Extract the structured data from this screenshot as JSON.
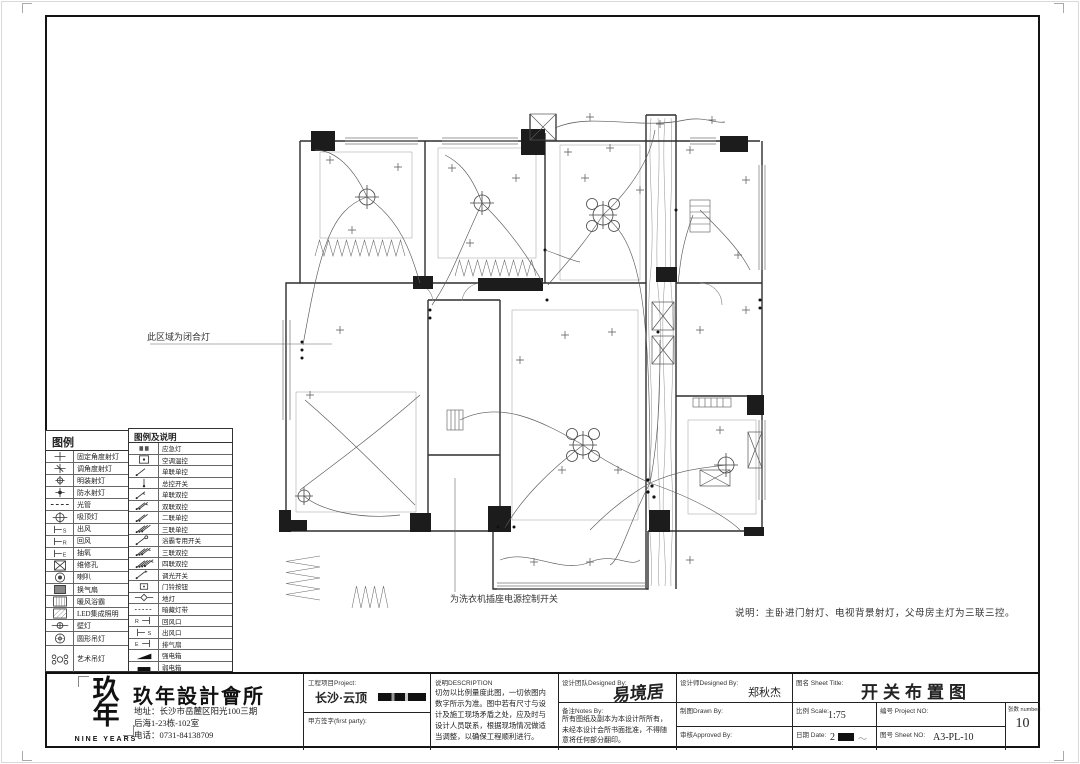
{
  "annotations": {
    "region_note": "此区域为闭合灯",
    "washer_note": "为洗衣机插座电源控制开关",
    "bottom_note": "说明：主卧进门射灯、电视背景射灯，父母房主灯为三联三控。"
  },
  "legend_left": {
    "title": "图例",
    "rows": [
      {
        "icon": "fixed-angle-spotlight-icon",
        "label": "固定角度射灯"
      },
      {
        "icon": "adjustable-angle-spotlight-icon",
        "label": "调角度射灯"
      },
      {
        "icon": "surface-spotlight-icon",
        "label": "明装射灯"
      },
      {
        "icon": "waterproof-spotlight-icon",
        "label": "防水射灯"
      },
      {
        "icon": "tube-light-icon",
        "label": "光管"
      },
      {
        "icon": "ceiling-lamp-icon",
        "label": "吸顶灯"
      },
      {
        "icon": "air-supply-icon",
        "label": "出风"
      },
      {
        "icon": "air-return-icon",
        "label": "回风"
      },
      {
        "icon": "air-extract-icon",
        "label": "抽氧"
      },
      {
        "icon": "access-panel-icon",
        "label": "维修孔"
      },
      {
        "icon": "speaker-icon",
        "label": "喇叭"
      },
      {
        "icon": "vent-fan-icon",
        "label": "换气扇"
      },
      {
        "icon": "bath-heater-icon",
        "label": "暖风浴霸"
      },
      {
        "icon": "led-panel-icon",
        "label": "LED集成照明"
      },
      {
        "icon": "wall-lamp-icon",
        "label": "壁灯"
      },
      {
        "icon": "round-pendant-icon",
        "label": "圆形吊灯"
      },
      {
        "icon": "art-pendant-icon",
        "label": "艺术吊灯"
      }
    ]
  },
  "legend_right": {
    "title": "图例及说明",
    "rows": [
      {
        "icon": "emergency-light-icon",
        "label": "应急灯"
      },
      {
        "icon": "thermostat-icon",
        "label": "空调温控"
      },
      {
        "icon": "switch-1g1w-icon",
        "label": "单联单控"
      },
      {
        "icon": "master-switch-icon",
        "label": "总控开关"
      },
      {
        "icon": "switch-1g2w-icon",
        "label": "单联双控"
      },
      {
        "icon": "switch-2g2w-icon",
        "label": "双联双控"
      },
      {
        "icon": "switch-2g1w-icon",
        "label": "二联单控"
      },
      {
        "icon": "switch-3g1w-icon",
        "label": "三联单控"
      },
      {
        "icon": "bath-heater-switch-icon",
        "label": "浴霸专用开关"
      },
      {
        "icon": "switch-3g2w-icon",
        "label": "三联双控"
      },
      {
        "icon": "switch-4g2w-icon",
        "label": "四联双控"
      },
      {
        "icon": "dimmer-switch-icon",
        "label": "调光开关"
      },
      {
        "icon": "doorbell-icon",
        "label": "门铃按钮"
      },
      {
        "icon": "floor-lamp-icon",
        "label": "地灯"
      },
      {
        "icon": "hidden-strip-icon",
        "label": "暗藏灯带"
      },
      {
        "icon": "return-vent-icon",
        "label": "回风口"
      },
      {
        "icon": "supply-vent-icon",
        "label": "出风口"
      },
      {
        "icon": "exhaust-fan-icon",
        "label": "排气扇"
      },
      {
        "icon": "strong-power-box-icon",
        "label": "强电箱"
      },
      {
        "icon": "weak-power-box-icon",
        "label": "弱电箱"
      }
    ]
  },
  "title_block": {
    "company": {
      "logo_chars": "玖年",
      "logo_sub": "NINE YEARS",
      "name": "玖年設計會所",
      "address1": "地址：长沙市岳麓区阳光100三期",
      "address2": "后海1-23栋-102室",
      "phone": "电话：0731-84138709"
    },
    "project": {
      "label": "工程项目Project:",
      "value": "长沙·云顶",
      "sign_label": "甲方签字(first party):"
    },
    "description": {
      "label": "说明DESCRIPTION",
      "text": "切勿以比例量度此图，一切依图内数字所示为准。图中若有尺寸与设计及施工现场矛盾之处，应及时与设计人员联系，根据现场情况做适当调整，以确保工程顺利进行。"
    },
    "team": {
      "label": "设计团队Designed By:",
      "value": "易境居",
      "designer_label": "设计师Designed By:",
      "designer": "郑秋杰",
      "notes_label": "备注Notes By:",
      "notes": "所有图纸及副本为本设计所所有，未经本设计会所书面批准，不得随意将任何部分翻印。",
      "drawn_label": "制图Drawn By:",
      "approved_label": "审核Approved By:"
    },
    "sheet": {
      "title_label": "图名 Sheet Title:",
      "title": "开关布置图",
      "scale_label": "比例 Scale:",
      "scale": "1:75",
      "no_label": "编号 Project NO:",
      "date_label": "日期 Date:",
      "date_value": "2",
      "sheetno_label": "图号 Sheet NO:",
      "sheetno": "A3-PL-10",
      "count_label": "张数 number:",
      "count": "10"
    }
  }
}
